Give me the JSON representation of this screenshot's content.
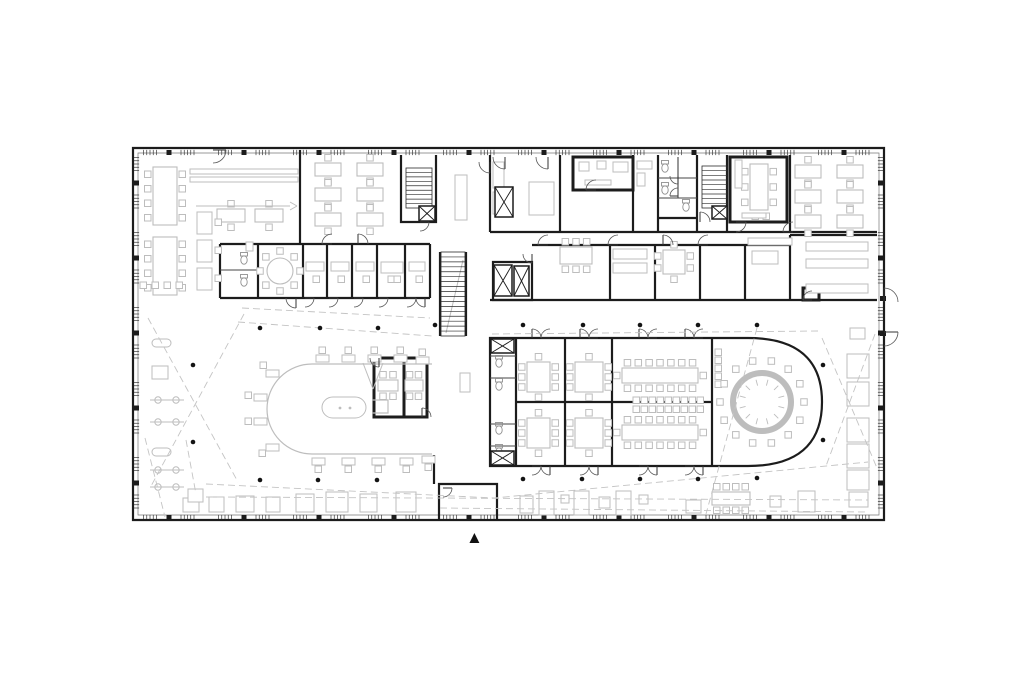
{
  "colors": {
    "wall": "#1c1c1c",
    "light": "#bdbdbd",
    "lighter": "#cccccc",
    "dash": "#c4c4c4",
    "tread": "#2e2e2e",
    "fixture": "#8f8f8f",
    "frame": "#777777",
    "dot": "#141414",
    "background": "#ffffff"
  },
  "north_marker": {
    "symbol": "▲"
  },
  "plan": {
    "frame_inner": "M138 153 H879 V515 H138 Z",
    "facade": {
      "top": [
        150,
        876,
        152.5
      ],
      "bottom": [
        150,
        876,
        517.5
      ],
      "left": [
        164,
        506,
        136.5
      ],
      "right": [
        164,
        506,
        880.5
      ],
      "step": 37.5,
      "ticks": 5,
      "span": 13,
      "col_step": 75,
      "col_size": 5
    },
    "walls_w2": [
      "M133 148 H884 V520 H133 Z",
      "M439 520 V484 H497 V520",
      "M401 155 V222 H436 V155",
      "M300 150 V244",
      "M220 244 H430",
      "M220 244 V298",
      "M220 298 H430",
      "M258 244 V298",
      "M303 244 V298",
      "M327 244 V298",
      "M352 244 V298",
      "M377 244 V298",
      "M405 244 V298",
      "M430 244 V298",
      "M490 155 V232",
      "M490 232 H877",
      "M560 155 V232",
      "M633 155 V232",
      "M658 155 V232",
      "M697 155 V232",
      "M727 155 V232",
      "M790 155 V232",
      "M658 218 H697",
      "M493 262 H532 V300 H493 Z",
      "M532 245 H790",
      "M610 245 V300",
      "M655 245 V300",
      "M700 245 V300",
      "M745 245 V300",
      "M790 235 H877",
      "M790 235 V300",
      "M490 300 H877",
      "M490 338 H748 C807 338 822 369 822 402 C822 435 807 466 748 466 H490 Z",
      "M516 338 V466",
      "M565 338 V466",
      "M612 338 V466",
      "M712 338 V466",
      "M516 402 H712",
      "M440 252 V336",
      "M466 252 V336",
      "M434 455 V484"
    ],
    "walls_w3": [
      "M573 157 H633 V190 H573 Z",
      "M730 157 H787 V222 H730 Z",
      "M803 288 H819 V300 H803 Z",
      "M374 358 H427 V417 H374 Z",
      "M404 358 V417"
    ],
    "walls_w1": [
      "M220 270 H258",
      "M658 178 H697",
      "M658 198 H697",
      "M678 157 V198",
      "M490 356 H516",
      "M490 378 H516",
      "M490 424 H516",
      "M490 446 H516"
    ],
    "black_squares": [
      [
        880,
        296,
        6,
        5
      ],
      [
        880,
        331,
        6,
        5
      ]
    ],
    "stairs": [
      {
        "x": 406,
        "y": 168,
        "w": 26,
        "h": 40,
        "n": 9
      },
      {
        "x": 441,
        "y": 252,
        "w": 24,
        "h": 84,
        "n": 17
      },
      {
        "x": 702,
        "y": 166,
        "w": 25,
        "h": 42,
        "n": 9
      }
    ],
    "elevators": [
      [
        419,
        206,
        16,
        15
      ],
      [
        495,
        187,
        18,
        30
      ],
      [
        494,
        265,
        18,
        31
      ],
      [
        514,
        266,
        15,
        30
      ],
      [
        712,
        206,
        15,
        13
      ],
      [
        491,
        339,
        23,
        14
      ],
      [
        491,
        451,
        23,
        14
      ]
    ],
    "tables_v": [
      [
        153,
        167,
        24,
        58,
        4,
        0
      ],
      [
        153,
        237,
        24,
        58,
        4,
        0
      ],
      [
        750,
        164,
        18,
        46,
        3,
        0
      ],
      [
        527,
        362,
        23,
        30,
        3,
        1
      ],
      [
        527,
        418,
        23,
        30,
        3,
        1
      ],
      [
        575,
        362,
        28,
        30,
        3,
        1
      ],
      [
        575,
        418,
        28,
        30,
        3,
        1
      ],
      [
        663,
        250,
        22,
        24,
        2,
        1
      ]
    ],
    "tables_h": [
      [
        315,
        163,
        26,
        13,
        1,
        0
      ],
      [
        357,
        163,
        26,
        13,
        1,
        0
      ],
      [
        315,
        188,
        26,
        13,
        1,
        0
      ],
      [
        357,
        188,
        26,
        13,
        1,
        0
      ],
      [
        315,
        213,
        26,
        13,
        1,
        0
      ],
      [
        357,
        213,
        26,
        13,
        1,
        0
      ],
      [
        795,
        165,
        26,
        13,
        1,
        0
      ],
      [
        837,
        165,
        26,
        13,
        1,
        0
      ],
      [
        795,
        190,
        26,
        13,
        1,
        0
      ],
      [
        837,
        190,
        26,
        13,
        1,
        0
      ],
      [
        795,
        215,
        26,
        13,
        1,
        0
      ],
      [
        837,
        215,
        26,
        13,
        1,
        0
      ],
      [
        217,
        209,
        28,
        13,
        1,
        0
      ],
      [
        255,
        209,
        28,
        13,
        1,
        0
      ],
      [
        560,
        247,
        32,
        17,
        3,
        0
      ],
      [
        622,
        368,
        76,
        15,
        7,
        1
      ],
      [
        622,
        425,
        76,
        15,
        7,
        1
      ],
      [
        378,
        380,
        20,
        11,
        2,
        0
      ],
      [
        405,
        380,
        18,
        11,
        2,
        0
      ],
      [
        712,
        492,
        38,
        13,
        4,
        0
      ]
    ],
    "chair_rows": [
      {
        "x": 633,
        "y": 397,
        "n": 9,
        "dx": 8,
        "dy": 0
      },
      {
        "x": 633,
        "y": 406,
        "n": 9,
        "dx": 8,
        "dy": 0
      },
      {
        "x": 715,
        "y": 349,
        "n": 5,
        "dx": 0,
        "dy": 8
      },
      {
        "x": 140,
        "y": 282,
        "n": 4,
        "dx": 12,
        "dy": 0
      }
    ],
    "chairs": [
      [
        215,
        219
      ],
      [
        215,
        247
      ],
      [
        215,
        275
      ],
      [
        313,
        276
      ],
      [
        338,
        276
      ],
      [
        363,
        276
      ],
      [
        388,
        276
      ],
      [
        394,
        276
      ],
      [
        416,
        276
      ],
      [
        752,
        213
      ],
      [
        763,
        213
      ]
    ],
    "desk_chairs": [
      [
        316,
        355,
        319,
        347
      ],
      [
        342,
        355,
        345,
        347
      ],
      [
        368,
        355,
        371,
        347
      ],
      [
        394,
        355,
        397,
        347
      ],
      [
        416,
        357,
        419,
        349
      ],
      [
        312,
        458,
        315,
        466
      ],
      [
        342,
        458,
        345,
        466
      ],
      [
        372,
        458,
        375,
        466
      ],
      [
        400,
        458,
        403,
        466
      ],
      [
        422,
        456,
        425,
        464
      ],
      [
        266,
        370,
        260,
        362
      ],
      [
        254,
        394,
        245,
        392
      ],
      [
        254,
        418,
        245,
        418
      ],
      [
        266,
        444,
        259,
        450
      ]
    ],
    "round_table": {
      "cx": 762,
      "cy": 402,
      "r_table": 29,
      "ring_w": 6,
      "r_chairs": 42,
      "n_chairs": 14,
      "n_ticks": 12,
      "r_tick1": 17,
      "r_tick2": 23
    },
    "round_small": {
      "cx": 280,
      "cy": 271,
      "r_table": 13,
      "r_chairs": 20,
      "n": 8
    },
    "light_rects": [
      [
        190,
        169,
        108,
        5,
        0
      ],
      [
        190,
        177,
        108,
        5,
        0
      ],
      [
        197,
        212,
        15,
        22,
        0
      ],
      [
        197,
        240,
        15,
        22,
        0
      ],
      [
        197,
        268,
        15,
        22,
        0
      ],
      [
        455,
        175,
        12,
        45,
        0
      ],
      [
        460,
        373,
        10,
        19,
        0
      ],
      [
        579,
        162,
        10,
        9,
        0
      ],
      [
        597,
        161,
        9,
        8,
        0
      ],
      [
        613,
        162,
        15,
        10,
        0
      ],
      [
        585,
        180,
        26,
        5,
        0
      ],
      [
        493,
        162,
        11,
        26,
        0
      ],
      [
        493,
        192,
        11,
        22,
        0
      ],
      [
        529,
        182,
        25,
        33,
        0
      ],
      [
        637,
        161,
        15,
        8,
        0
      ],
      [
        637,
        173,
        8,
        13,
        0
      ],
      [
        735,
        160,
        7,
        28,
        0
      ],
      [
        742,
        213,
        24,
        5,
        0
      ],
      [
        806,
        242,
        62,
        9,
        0
      ],
      [
        806,
        259,
        62,
        9,
        0
      ],
      [
        806,
        284,
        62,
        9,
        0
      ],
      [
        748,
        238,
        44,
        7,
        0
      ],
      [
        752,
        251,
        26,
        13,
        0
      ],
      [
        613,
        249,
        34,
        10,
        0
      ],
      [
        613,
        263,
        34,
        10,
        0
      ],
      [
        306,
        262,
        18,
        9,
        0
      ],
      [
        331,
        262,
        18,
        9,
        0
      ],
      [
        356,
        262,
        18,
        9,
        0
      ],
      [
        381,
        262,
        22,
        11,
        0
      ],
      [
        409,
        262,
        16,
        9,
        0
      ],
      [
        322,
        397,
        44,
        21,
        11
      ],
      [
        847,
        354,
        22,
        24,
        0
      ],
      [
        847,
        382,
        22,
        24,
        0
      ],
      [
        847,
        418,
        22,
        24,
        0
      ],
      [
        847,
        444,
        22,
        24,
        0
      ],
      [
        847,
        470,
        22,
        20,
        0
      ],
      [
        849,
        492,
        19,
        15,
        0
      ],
      [
        850,
        328,
        15,
        11,
        0
      ],
      [
        183,
        498,
        16,
        14,
        0
      ],
      [
        209,
        497,
        15,
        15,
        0
      ],
      [
        236,
        496,
        18,
        16,
        0
      ],
      [
        266,
        497,
        14,
        15,
        0
      ],
      [
        296,
        494,
        18,
        18,
        0
      ],
      [
        326,
        492,
        22,
        20,
        0
      ],
      [
        360,
        494,
        17,
        18,
        0
      ],
      [
        396,
        492,
        20,
        20,
        0
      ],
      [
        520,
        496,
        13,
        17,
        0
      ],
      [
        539,
        491,
        15,
        24,
        0
      ],
      [
        561,
        495,
        8,
        8,
        0
      ],
      [
        574,
        491,
        15,
        24,
        0
      ],
      [
        599,
        497,
        11,
        11,
        0
      ],
      [
        616,
        491,
        15,
        24,
        0
      ],
      [
        639,
        495,
        9,
        9,
        0
      ],
      [
        686,
        500,
        15,
        13,
        0
      ],
      [
        770,
        496,
        11,
        11,
        0
      ],
      [
        798,
        491,
        17,
        21,
        0
      ],
      [
        152,
        366,
        16,
        13,
        0
      ],
      [
        152,
        339,
        19,
        8,
        4
      ],
      [
        152,
        448,
        19,
        8,
        4
      ],
      [
        246,
        242,
        7,
        9,
        0
      ],
      [
        188,
        489,
        15,
        13,
        0
      ]
    ],
    "light_lines": [
      [
        196,
        206,
        290,
        206
      ],
      [
        290,
        202,
        297,
        206
      ],
      [
        290,
        210,
        297,
        206
      ],
      [
        446,
        333,
        463,
        260
      ],
      [
        363,
        363,
        373,
        389
      ],
      [
        383,
        363,
        373,
        389
      ]
    ],
    "light_paths": [
      "M432 364 H312 A45 45 0 0 0 312 454 H432",
      "M372 400 h16 v13 h-16"
    ],
    "light_circles": [
      [
        340,
        408,
        1.4
      ],
      [
        350,
        408,
        1.4
      ]
    ],
    "gym": {
      "x1": 150,
      "x2": 184,
      "ys": [
        400,
        422,
        470,
        487
      ],
      "c1": 158,
      "c2": 176,
      "r": 3.2
    },
    "toilets": [
      [
        244,
        258
      ],
      [
        244,
        280
      ],
      [
        665,
        166
      ],
      [
        665,
        188
      ],
      [
        686,
        205
      ],
      [
        499,
        361
      ],
      [
        499,
        384
      ],
      [
        499,
        428
      ],
      [
        499,
        450
      ]
    ],
    "doors": [
      [
        213,
        150,
        13,
        0,
        90
      ],
      [
        505,
        157,
        12,
        90,
        180
      ],
      [
        548,
        157,
        12,
        90,
        180
      ],
      [
        490,
        162,
        11,
        90,
        180
      ],
      [
        596,
        190,
        10,
        180,
        270
      ],
      [
        678,
        176,
        8,
        90,
        180
      ],
      [
        678,
        196,
        8,
        180,
        270
      ],
      [
        700,
        222,
        10,
        270,
        360
      ],
      [
        736,
        222,
        10,
        0,
        90
      ],
      [
        793,
        232,
        10,
        180,
        270
      ],
      [
        420,
        222,
        9,
        0,
        90
      ],
      [
        548,
        245,
        10,
        180,
        270
      ],
      [
        618,
        245,
        10,
        180,
        270
      ],
      [
        663,
        245,
        10,
        270,
        360
      ],
      [
        708,
        245,
        10,
        180,
        270
      ],
      [
        812,
        300,
        9,
        180,
        270
      ],
      [
        532,
        254,
        9,
        90,
        180
      ],
      [
        296,
        298,
        10,
        90,
        180
      ],
      [
        305,
        298,
        9,
        0,
        90
      ],
      [
        329,
        298,
        9,
        0,
        90
      ],
      [
        354,
        298,
        9,
        0,
        90
      ],
      [
        379,
        298,
        9,
        0,
        90
      ],
      [
        407,
        298,
        9,
        0,
        90
      ],
      [
        425,
        298,
        9,
        90,
        180
      ],
      [
        332,
        244,
        10,
        180,
        270
      ],
      [
        358,
        244,
        10,
        270,
        360
      ],
      [
        379,
        358,
        9,
        90,
        180
      ],
      [
        422,
        417,
        9,
        270,
        360
      ],
      [
        443,
        488,
        9,
        0,
        90
      ],
      [
        884,
        302,
        14,
        270,
        360
      ],
      [
        884,
        332,
        14,
        0,
        90
      ]
    ],
    "double_doors": [
      {
        "x": 541,
        "y": 338,
        "up": true
      },
      {
        "x": 589,
        "y": 338,
        "up": true
      },
      {
        "x": 648,
        "y": 338,
        "up": true
      },
      {
        "x": 694,
        "y": 338,
        "up": true
      },
      {
        "x": 541,
        "y": 466,
        "up": false
      },
      {
        "x": 589,
        "y": 466,
        "up": false
      },
      {
        "x": 648,
        "y": 466,
        "up": false
      },
      {
        "x": 694,
        "y": 466,
        "up": false
      }
    ],
    "dashed": [
      "148,318 238,482",
      "244,314 150,488",
      "145,438 165,517",
      "186,440 196,494",
      "238,322 432,336",
      "242,308 430,318",
      "492,334 818,331",
      "822,338 877,468",
      "875,334 826,466",
      "757,328 706,514",
      "206,484 494,498 868,462",
      "206,497 868,500",
      "440,508 868,512"
    ],
    "dots": [
      [
        193,
        365
      ],
      [
        193,
        442
      ],
      [
        260,
        328
      ],
      [
        320,
        328
      ],
      [
        378,
        328
      ],
      [
        435,
        325
      ],
      [
        523,
        325
      ],
      [
        583,
        325
      ],
      [
        640,
        325
      ],
      [
        698,
        325
      ],
      [
        757,
        325
      ],
      [
        260,
        480
      ],
      [
        318,
        480
      ],
      [
        377,
        480
      ],
      [
        523,
        479
      ],
      [
        582,
        479
      ],
      [
        640,
        479
      ],
      [
        698,
        479
      ],
      [
        757,
        478
      ],
      [
        823,
        365
      ],
      [
        823,
        440
      ]
    ]
  }
}
